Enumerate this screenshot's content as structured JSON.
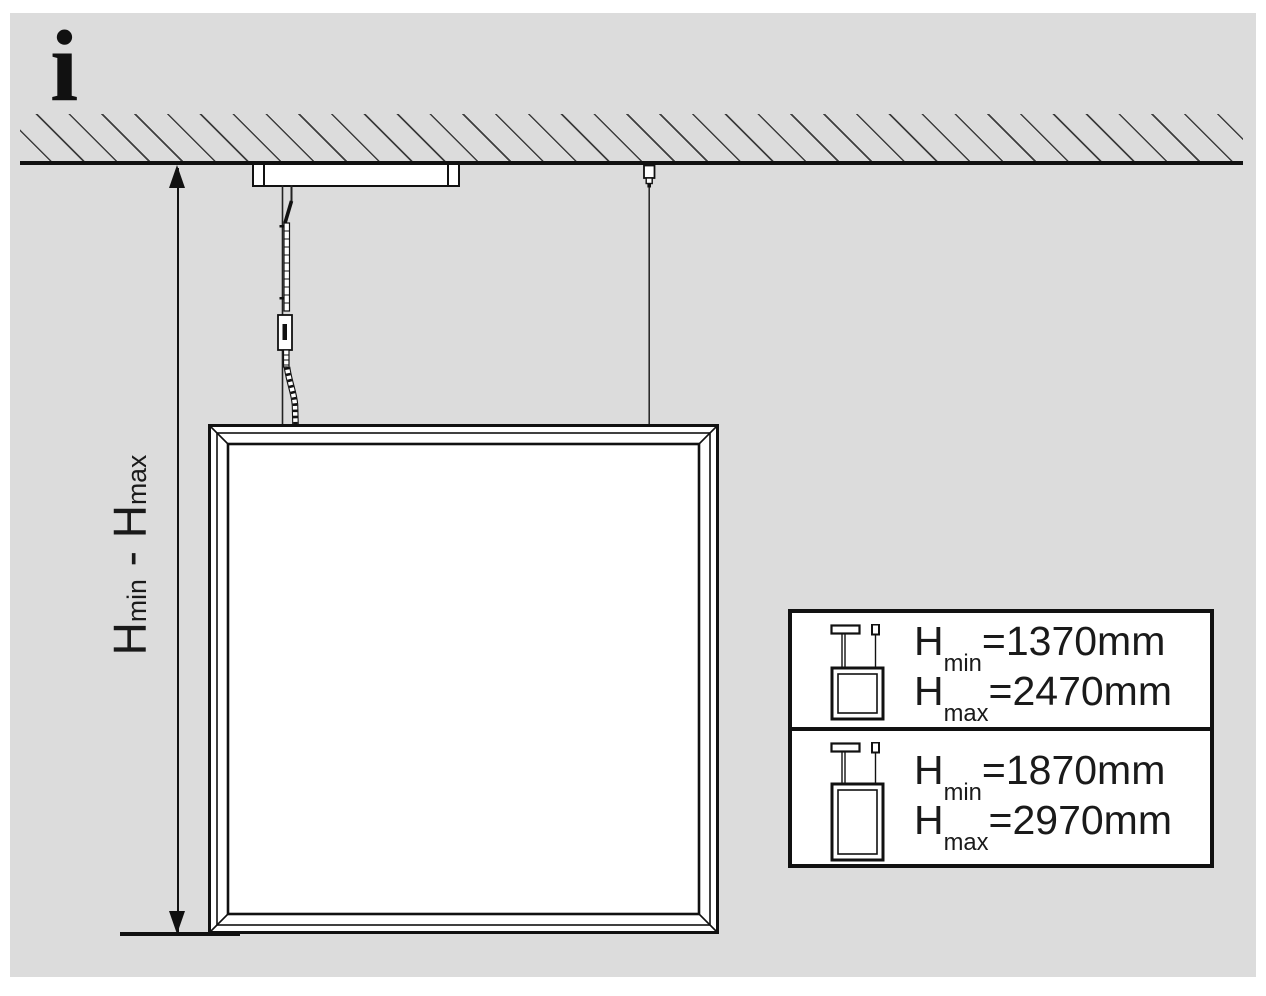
{
  "info_symbol": "i",
  "dimension": {
    "h1": "H",
    "sub1": "min",
    "sep": " - ",
    "h2": "H",
    "sub2": "max"
  },
  "table": {
    "rows": [
      {
        "panel_icon": "square-panel-icon",
        "lines": [
          {
            "h": "H",
            "sub": "min",
            "value": "=1370mm"
          },
          {
            "h": "H",
            "sub": "max",
            "value": "=2470mm"
          }
        ]
      },
      {
        "panel_icon": "tall-panel-icon",
        "lines": [
          {
            "h": "H",
            "sub": "min",
            "value": "=1870mm"
          },
          {
            "h": "H",
            "sub": "max",
            "value": "=2970mm"
          }
        ]
      }
    ]
  },
  "colors": {
    "background": "#dcdcdc",
    "line": "#111111",
    "fill": "#ffffff"
  }
}
